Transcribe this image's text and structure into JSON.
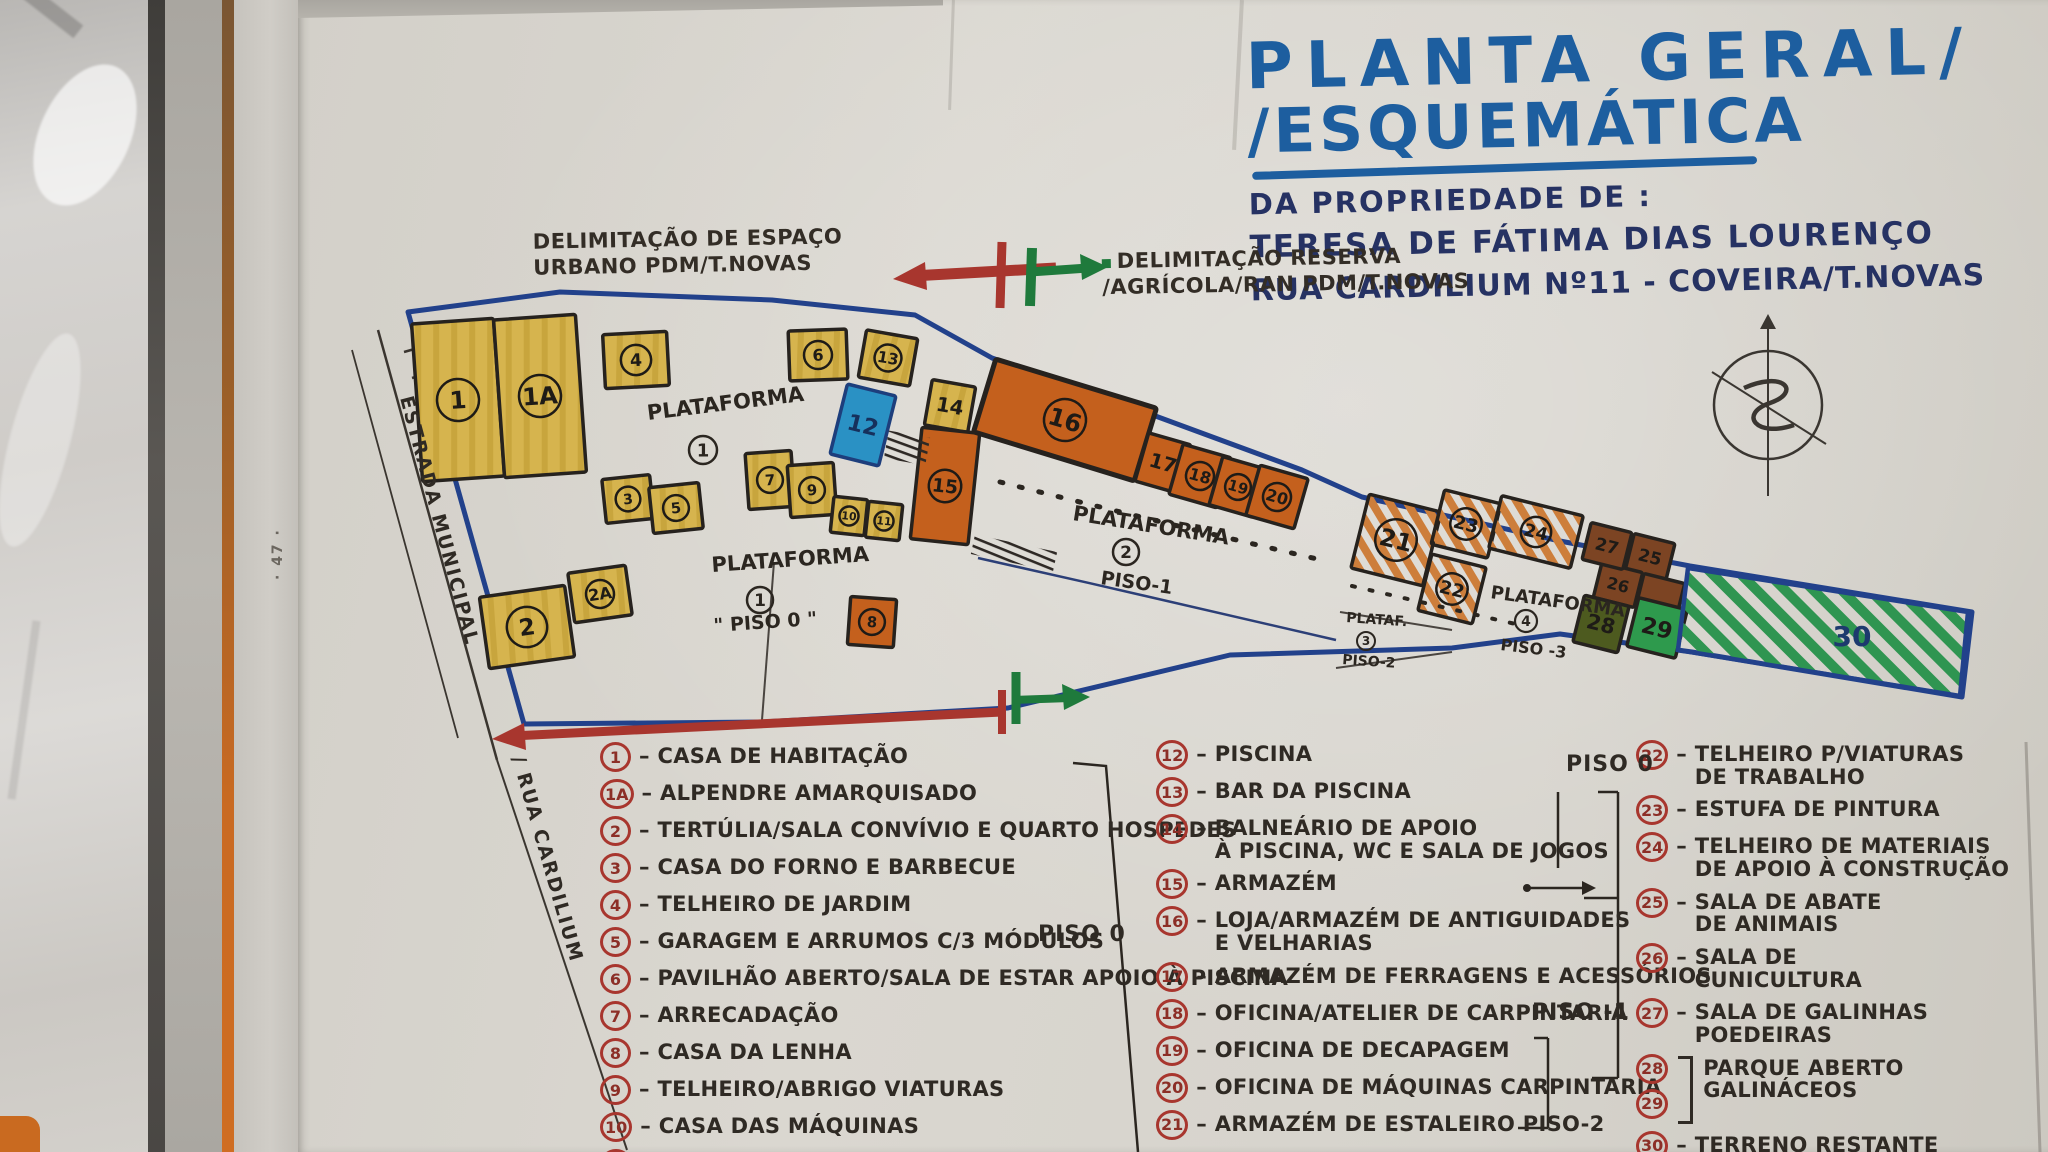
{
  "palette": {
    "paper": "#d7d4cd",
    "ink": "#2f2a24",
    "marker_blue": "#1d5e9f",
    "navy": "#263263",
    "red": "#a8362e",
    "green": "#1f7a3c",
    "boundary_blue": "#22418b",
    "plot_yellow": "#d6b44e",
    "plot_orange": "#c4601d",
    "plot_orange_hatch": "#cd7e3b",
    "plot_brown": "#7c4423",
    "plot_olive": "#4d5a1f",
    "plot_green": "#2e9a4d",
    "pool_blue": "#2a91c4"
  },
  "title": {
    "line1": "PLANTA GERAL/",
    "line2": "/ESQUEMÁTICA",
    "subtitle": "DA PROPRIEDADE DE :",
    "owner": "TERESA DE FÁTIMA DIAS LOURENÇO",
    "address": "RUA CARDILIUM Nº11 - COVEIRA/T.NOVAS"
  },
  "annotations": {
    "urban": {
      "line1": "DELIMITAÇÃO DE ESPAÇO",
      "line2": "URBANO PDM/T.NOVAS"
    },
    "reserve": {
      "line1": "DELIMITAÇÃO RESERVA",
      "line2": "/AGRÍCOLA/RAN PDM/T.NOVAS"
    },
    "road": {
      "line1": "ESTRADA MUNICIPAL",
      "line2": "/ RUA CARDILIUM"
    },
    "margin_note": "· 47 ·"
  },
  "plan": {
    "platforms": [
      {
        "name": "PLATAFORMA",
        "num": "1",
        "caption": ""
      },
      {
        "name": "PLATAFORMA",
        "num": "1",
        "caption": "\" PISO 0 \""
      },
      {
        "name": "PLATAFORMA",
        "num": "2",
        "caption": "PISO-1"
      },
      {
        "name": "PLATAF.",
        "num": "3",
        "caption": "PISO-2"
      },
      {
        "name": "PLATAFORMA",
        "num": "4",
        "caption": "PISO -3"
      }
    ],
    "plots": [
      {
        "id": "1",
        "label": "1"
      },
      {
        "id": "1A",
        "label": "1A"
      },
      {
        "id": "2",
        "label": "2"
      },
      {
        "id": "2A",
        "label": "2A"
      },
      {
        "id": "3",
        "label": "3"
      },
      {
        "id": "4",
        "label": "4"
      },
      {
        "id": "5",
        "label": "5"
      },
      {
        "id": "6",
        "label": "6"
      },
      {
        "id": "7",
        "label": "7"
      },
      {
        "id": "8",
        "label": "8"
      },
      {
        "id": "9",
        "label": "9"
      },
      {
        "id": "10",
        "label": "10"
      },
      {
        "id": "11",
        "label": "11"
      },
      {
        "id": "12",
        "label": "12"
      },
      {
        "id": "13",
        "label": "13"
      },
      {
        "id": "14",
        "label": "14"
      },
      {
        "id": "15",
        "label": "15"
      },
      {
        "id": "16",
        "label": "16"
      },
      {
        "id": "17",
        "label": "17"
      },
      {
        "id": "18",
        "label": "18"
      },
      {
        "id": "19",
        "label": "19"
      },
      {
        "id": "20",
        "label": "20"
      },
      {
        "id": "21",
        "label": "21"
      },
      {
        "id": "22",
        "label": "22"
      },
      {
        "id": "23",
        "label": "23"
      },
      {
        "id": "24",
        "label": "24"
      },
      {
        "id": "25",
        "label": "25"
      },
      {
        "id": "26",
        "label": "26"
      },
      {
        "id": "27",
        "label": "27"
      },
      {
        "id": "b1",
        "label": ""
      },
      {
        "id": "28",
        "label": "28"
      },
      {
        "id": "29",
        "label": "29"
      },
      {
        "id": "30",
        "label": "30"
      }
    ]
  },
  "legend": {
    "piso0_mid": "PISO 0",
    "piso0_col3": "PISO 0",
    "piso_minus1": "PISO -1",
    "columns": [
      [
        {
          "num": "1",
          "text": "CASA DE HABITAÇÃO"
        },
        {
          "num": "1A",
          "text": "ALPENDRE AMARQUISADO"
        },
        {
          "num": "2",
          "text": "TERTÚLIA/SALA CONVÍVIO E QUARTO HOSPEDES"
        },
        {
          "num": "3",
          "text": "CASA DO FORNO E BARBECUE"
        },
        {
          "num": "4",
          "text": "TELHEIRO DE JARDIM"
        },
        {
          "num": "5",
          "text": "GARAGEM E ARRUMOS C/3 MÓDULOS"
        },
        {
          "num": "6",
          "text": "PAVILHÃO ABERTO/SALA DE ESTAR APOIO À PISCINA"
        },
        {
          "num": "7",
          "text": "ARRECADAÇÃO"
        },
        {
          "num": "8",
          "text": "CASA DA LENHA"
        },
        {
          "num": "9",
          "text": "TELHEIRO/ABRIGO VIATURAS"
        },
        {
          "num": "10",
          "text": "CASA DAS MÁQUINAS"
        },
        {
          "num": "11",
          "text": ""
        }
      ],
      [
        {
          "num": "12",
          "text": "PISCINA"
        },
        {
          "num": "13",
          "text": "BAR DA PISCINA"
        },
        {
          "num": "14",
          "text": "BALNEÁRIO DE APOIO",
          "text2": "À PISCINA, WC E SALA DE JOGOS"
        },
        {
          "num": "15",
          "text": "ARMAZÉM"
        },
        {
          "num": "16",
          "text": "LOJA/ARMAZÉM DE ANTIGUIDADES",
          "text2": "E VELHARIAS"
        },
        {
          "num": "17",
          "text": "ARMAZÉM DE FERRAGENS E ACESSÓRIOS"
        },
        {
          "num": "18",
          "text": "OFICINA/ATELIER DE CARPINTARIA"
        },
        {
          "num": "19",
          "text": "OFICINA DE DECAPAGEM"
        },
        {
          "num": "20",
          "text": "OFICINA DE MÁQUINAS CARPINTARIA"
        },
        {
          "num": "21",
          "text": "ARMAZÉM DE ESTALEIRO PISO-2"
        }
      ],
      [
        {
          "num": "22",
          "text": "TELHEIRO P/VIATURAS",
          "text2": "DE TRABALHO"
        },
        {
          "num": "23",
          "text": "ESTUFA DE PINTURA"
        },
        {
          "num": "24",
          "text": "TELHEIRO DE MATERIAIS",
          "text2": "DE APOIO À CONSTRUÇÃO"
        },
        {
          "num": "25",
          "text": "SALA DE ABATE",
          "text2": "DE ANIMAIS"
        },
        {
          "num": "26",
          "text": "SALA DE",
          "text2": "CUNICULTURA"
        },
        {
          "num": "27",
          "text": "SALA DE GALINHAS",
          "text2": "POEDEIRAS"
        },
        {
          "nums": [
            "28",
            "29"
          ],
          "text": "PARQUE ABERTO",
          "text2": "GALINÁCEOS"
        },
        {
          "num": "30",
          "text": "TERRENO RESTANTE"
        }
      ]
    ]
  }
}
